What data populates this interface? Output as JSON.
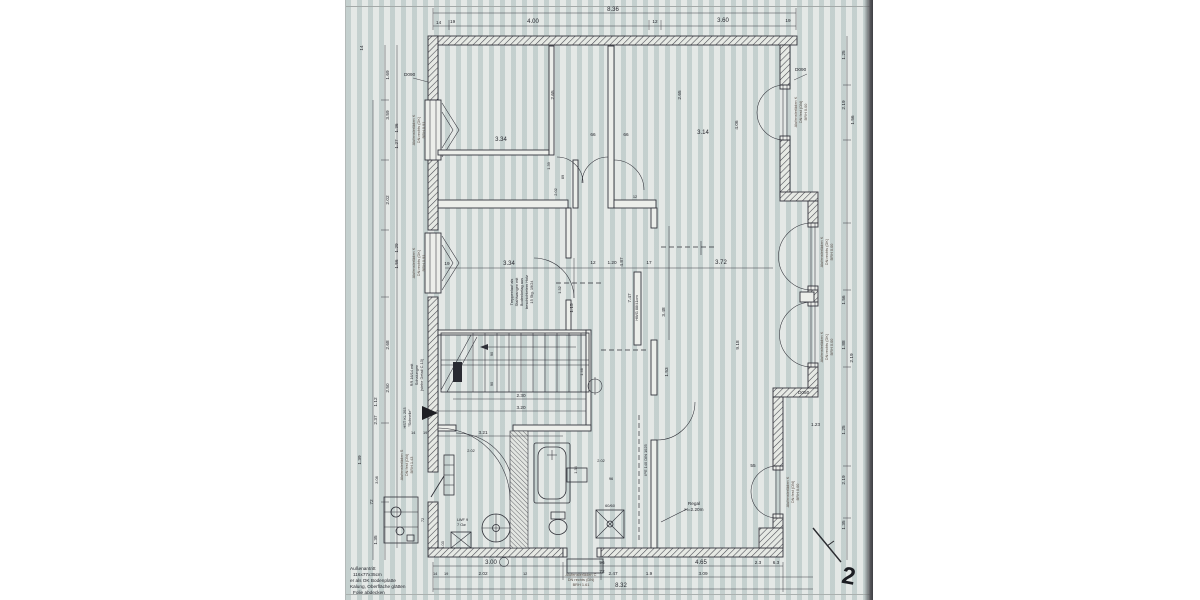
{
  "document": {
    "kind": "Scanned architectural floor plan (Grundriss), black ink on blue-grey blueprint paper",
    "page_mark": "2",
    "colors": {
      "paper": "#d3d9d7",
      "stripe": "#eef2ef",
      "ink": "#2e2f37",
      "edge_shadow": "#4a4b4f",
      "label_ink": "#564a44"
    }
  },
  "dims": {
    "top": [
      "8.36",
      "14",
      "19",
      "4.00",
      "12",
      "3.60",
      "19"
    ],
    "left": [
      "1.69",
      "3.59",
      "1.36",
      "1.27",
      "2.02",
      "1.29",
      "1.56",
      "2.68",
      "2.50",
      "1.12",
      "2.37",
      "1.39",
      "72",
      "1.35",
      "14"
    ],
    "right": [
      "1.25",
      "2.19",
      "1.56",
      "1.88",
      "2.19",
      "1.56",
      "1.25",
      "2.19",
      "1.35",
      "1.23"
    ],
    "bottom": [
      "3.00",
      "96",
      "72",
      "4.65",
      "2.3",
      "6.3",
      "2.02",
      "2.47",
      "1.9",
      "3.09",
      "8.32",
      "14",
      "19",
      "12"
    ],
    "inner": [
      "3.34",
      "66",
      "66",
      "3.14",
      "2.65",
      "2.65",
      "4.06",
      "89",
      "2.02",
      "1.39",
      "19",
      "3.34",
      "12",
      "1.20",
      "17",
      "3.72",
      "12",
      "1.15",
      "1.32",
      "4.87",
      "7.47",
      "3.48",
      "1.53",
      "9.18",
      "1.46",
      "90",
      "90",
      "2.30",
      "3.20",
      "3.21",
      "14",
      "19",
      "1.34",
      "2.02",
      "96",
      "55",
      "1.03",
      "72",
      "2.02",
      "3.08"
    ]
  },
  "labels": {
    "d090_left": "D090",
    "d090_right": "D090",
    "d050": "D050",
    "win_left_1": [
      "Alufensterläden K",
      "DN rechts (DK)",
      "BRH 0.91"
    ],
    "win_left_2": [
      "Alufensterläden K",
      "DN rechts (DK)",
      "BRH 0.91"
    ],
    "door_left": [
      "Alufensterläden S",
      "DN fest (DN)",
      "BRH 1.43"
    ],
    "win_right_top": [
      "Alufensterläden K",
      "DN fest (DN)",
      "BRH 0.00"
    ],
    "win_right_1": [
      "Alufensterläden K",
      "DN rechts (DK)",
      "BRH 0.00"
    ],
    "win_right_2": [
      "Alufensterläden K",
      "DN rechts (DK)",
      "BRH 0.00"
    ],
    "win_right_3": [
      "Alufensterläden K",
      "DN fest (DN)",
      "BRH 0.00"
    ],
    "door_bottom": [
      "Alufensterläden C",
      "DN rechts (DN)",
      "BRH 1.61"
    ],
    "stair_note": [
      "RR 16/14 mit",
      "Schalungen",
      "(siehe Detail C.13)"
    ],
    "hst_note": [
      "HST KL 203",
      "\"Schnelle\""
    ],
    "mid_note": [
      "Treppenlauf als",
      "Stahlwangen mit",
      "Bodenbelag aus",
      "beschichtetem Holz",
      "15 Stg. 19/24"
    ],
    "beam_note": "IPE 140 DIN 1025",
    "pier_note": "HWG 88/41cm",
    "regal": [
      "Regal",
      "H=2.20m"
    ],
    "lwf": [
      "LWF 9",
      "7 Oø"
    ],
    "unit6060": "60/60",
    "corner_note": [
      "Außenantritt",
      "116x77x35cm",
      "er als OK Bodenplatte",
      "Kalung, Oberfläche glätten",
      "Folie abdecken"
    ],
    "north_mark": "2"
  }
}
